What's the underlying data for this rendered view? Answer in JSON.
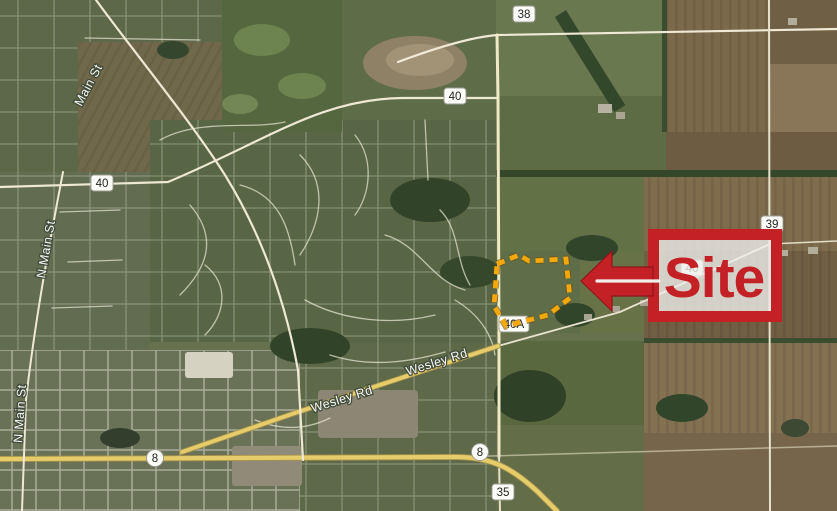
{
  "map": {
    "street_labels": [
      {
        "name": "Main St"
      },
      {
        "name": "N Main St"
      },
      {
        "name": "N Main St"
      },
      {
        "name": "Wesley Rd"
      },
      {
        "name": "Wesley Rd"
      }
    ],
    "route_shields": [
      {
        "number": "38"
      },
      {
        "number": "40"
      },
      {
        "number": "40"
      },
      {
        "number": "39"
      },
      {
        "number": "40"
      },
      {
        "number": "40A"
      },
      {
        "number": "8"
      },
      {
        "number": "8"
      },
      {
        "number": "35"
      }
    ]
  },
  "annotations": {
    "site_label": "Site",
    "callout_color": "#c42127",
    "boundary_color": "#f4a80c"
  }
}
